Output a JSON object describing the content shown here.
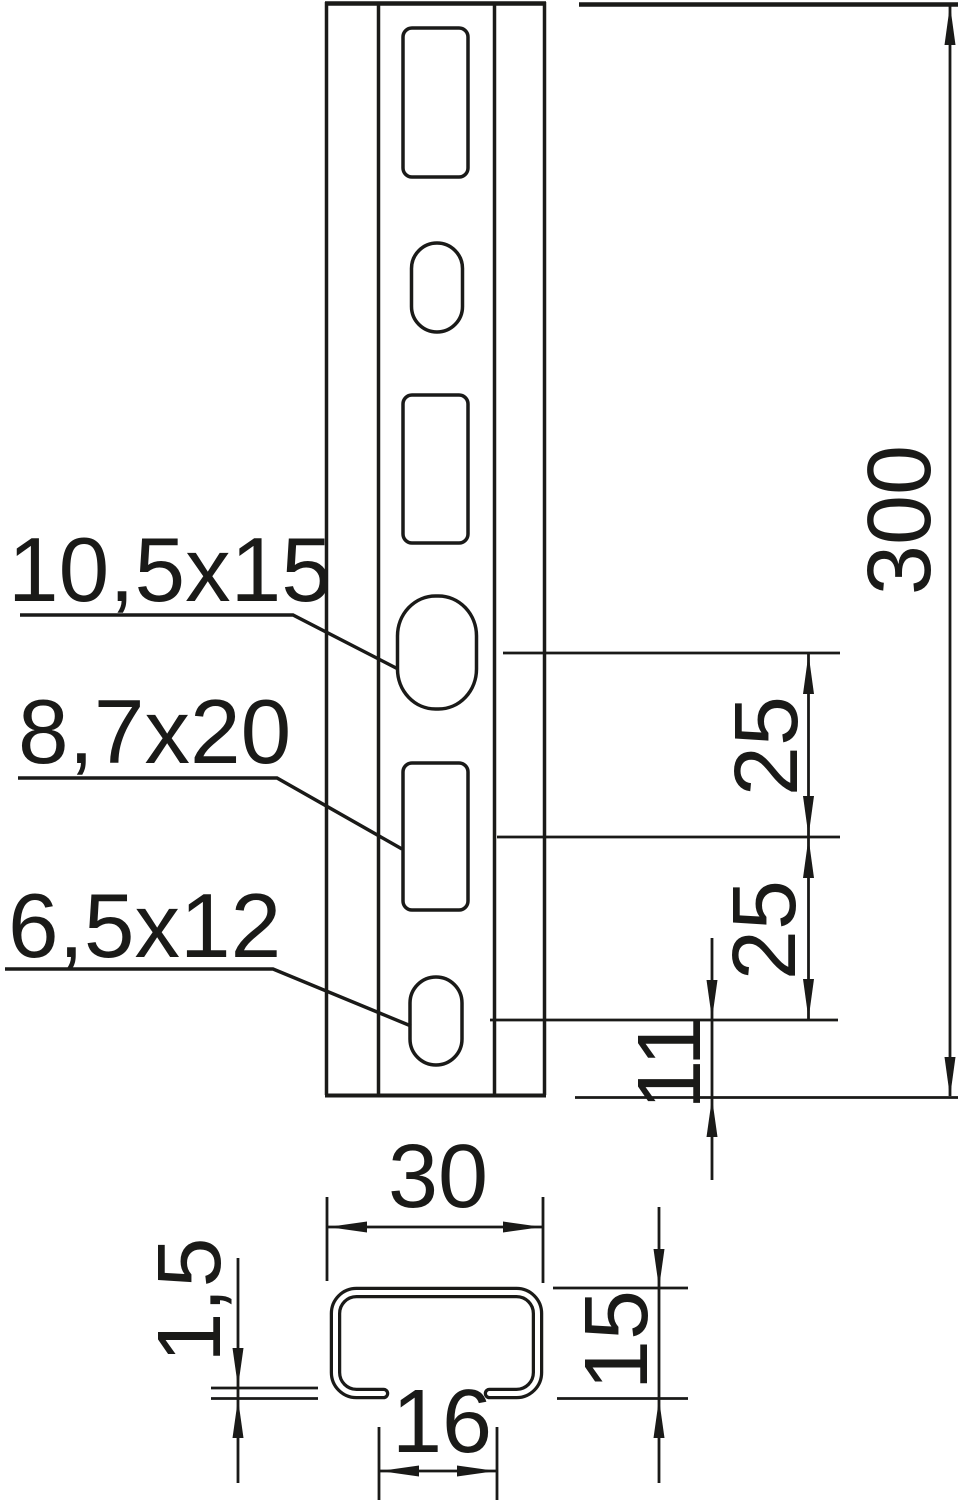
{
  "colors": {
    "line": "#1a1a18",
    "background": "#ffffff"
  },
  "hole_labels": {
    "large_oval": "10,5x15",
    "rect_slot": "8,7x20",
    "small_oval": "6,5x12"
  },
  "dimensions": {
    "overall_length": "300",
    "upper_hole_spacing": "25",
    "lower_hole_spacing": "25",
    "bottom_end_offset": "11",
    "profile_width": "30",
    "slot_opening_width": "16",
    "profile_height": "15",
    "wall_thickness": "1,5"
  }
}
